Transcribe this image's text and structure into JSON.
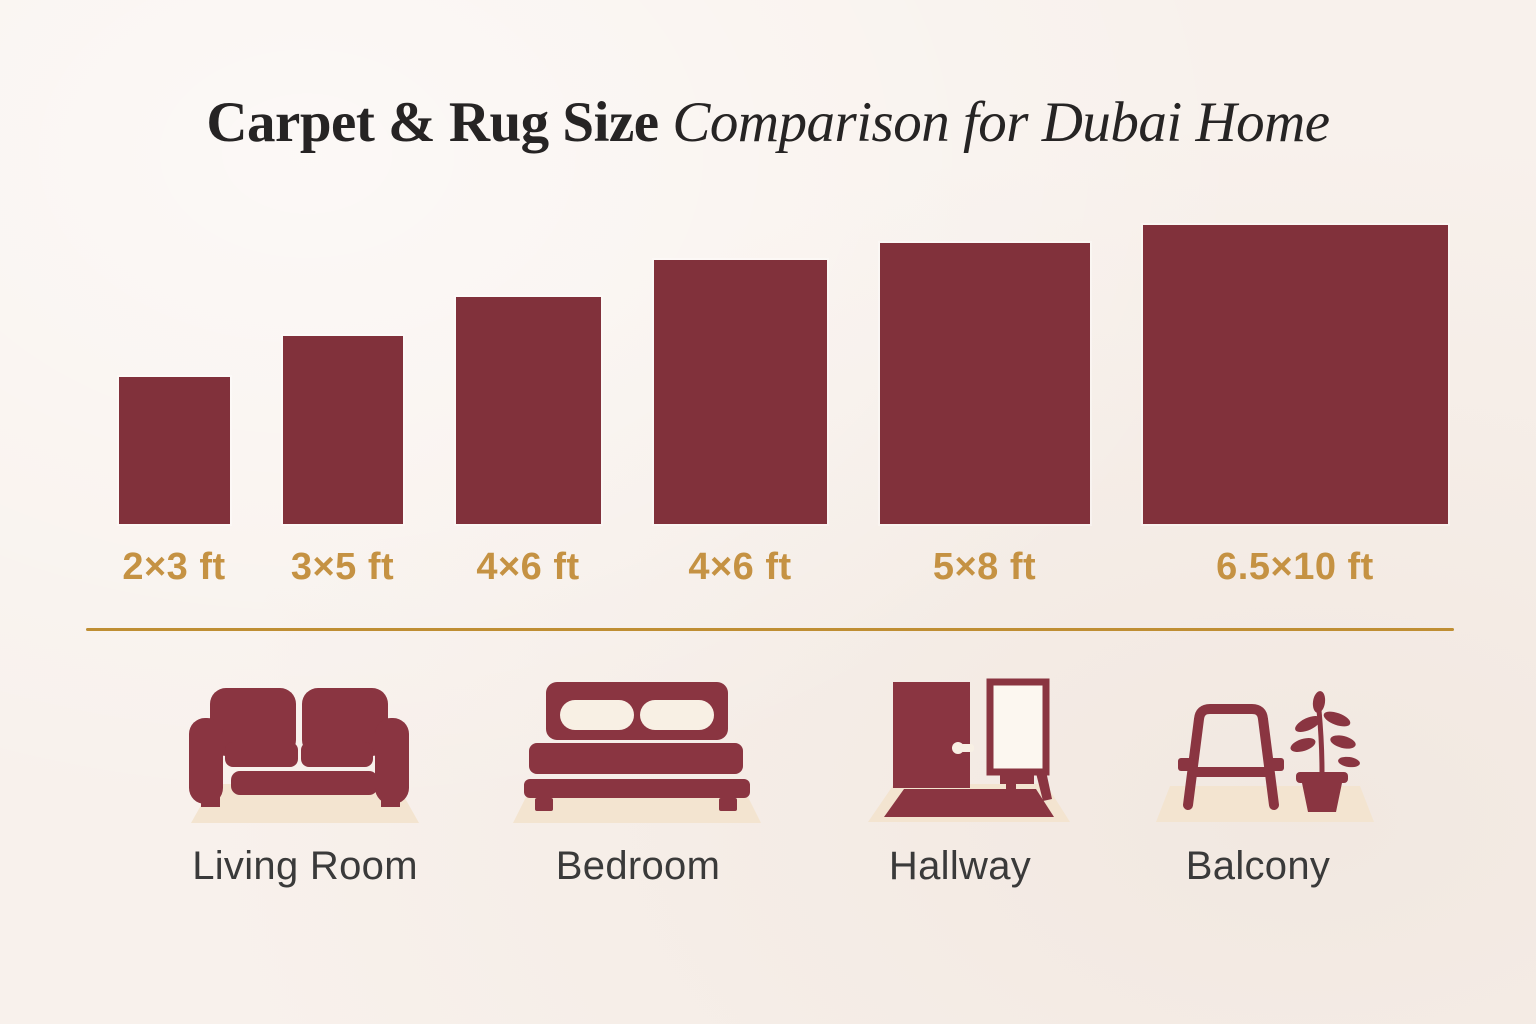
{
  "title": {
    "regular": "Carpet & Rug Size",
    "italic": " Comparison for Dubai Home"
  },
  "chart_data": {
    "type": "bar",
    "title": "Carpet & Rug Size Comparison for Dubai Home",
    "categories": [
      "2×3 ft",
      "3×5 ft",
      "4×6 ft",
      "4×6 ft",
      "5×8 ft",
      "6.5×10 ft"
    ],
    "series": [
      {
        "name": "width_ft",
        "values": [
          2,
          3,
          4,
          4,
          5,
          6.5
        ]
      },
      {
        "name": "length_ft",
        "values": [
          3,
          5,
          6,
          6,
          8,
          10
        ]
      }
    ],
    "legend": false,
    "notes": "Maroon rectangles drawn bottom-aligned, scaled to relative rug footprint"
  },
  "rugs": [
    {
      "label": "2×3 ft",
      "width_ft": 2,
      "length_ft": 3,
      "block_w": 111,
      "block_h": 147
    },
    {
      "label": "3×5 ft",
      "width_ft": 3,
      "length_ft": 5,
      "block_w": 120,
      "block_h": 188
    },
    {
      "label": "4×6 ft",
      "width_ft": 4,
      "length_ft": 6,
      "block_w": 145,
      "block_h": 227
    },
    {
      "label": "4×6 ft",
      "width_ft": 4,
      "length_ft": 6,
      "block_w": 173,
      "block_h": 264
    },
    {
      "label": "5×8 ft",
      "width_ft": 5,
      "length_ft": 8,
      "block_w": 210,
      "block_h": 281
    },
    {
      "label": "6.5×10 ft",
      "width_ft": 6.5,
      "length_ft": 10,
      "block_w": 305,
      "block_h": 299
    }
  ],
  "rooms": [
    {
      "label": "Living Room",
      "icon": "sofa-icon"
    },
    {
      "label": "Bedroom",
      "icon": "bed-icon"
    },
    {
      "label": "Hallway",
      "icon": "door-and-mirror-icon"
    },
    {
      "label": "Balcony",
      "icon": "chair-and-plant-icon"
    }
  ],
  "colors": {
    "background": "#f8f1ec",
    "rug_maroon": "#81313b",
    "icon_maroon": "#8a3541",
    "size_label_gold": "#c59243",
    "divider_gold": "#bf8e33",
    "title_ink": "#262424",
    "room_label_ink": "#3a3a3a",
    "mat_beige": "#f3e4d0",
    "pillow_cream": "#f8f0e4"
  }
}
